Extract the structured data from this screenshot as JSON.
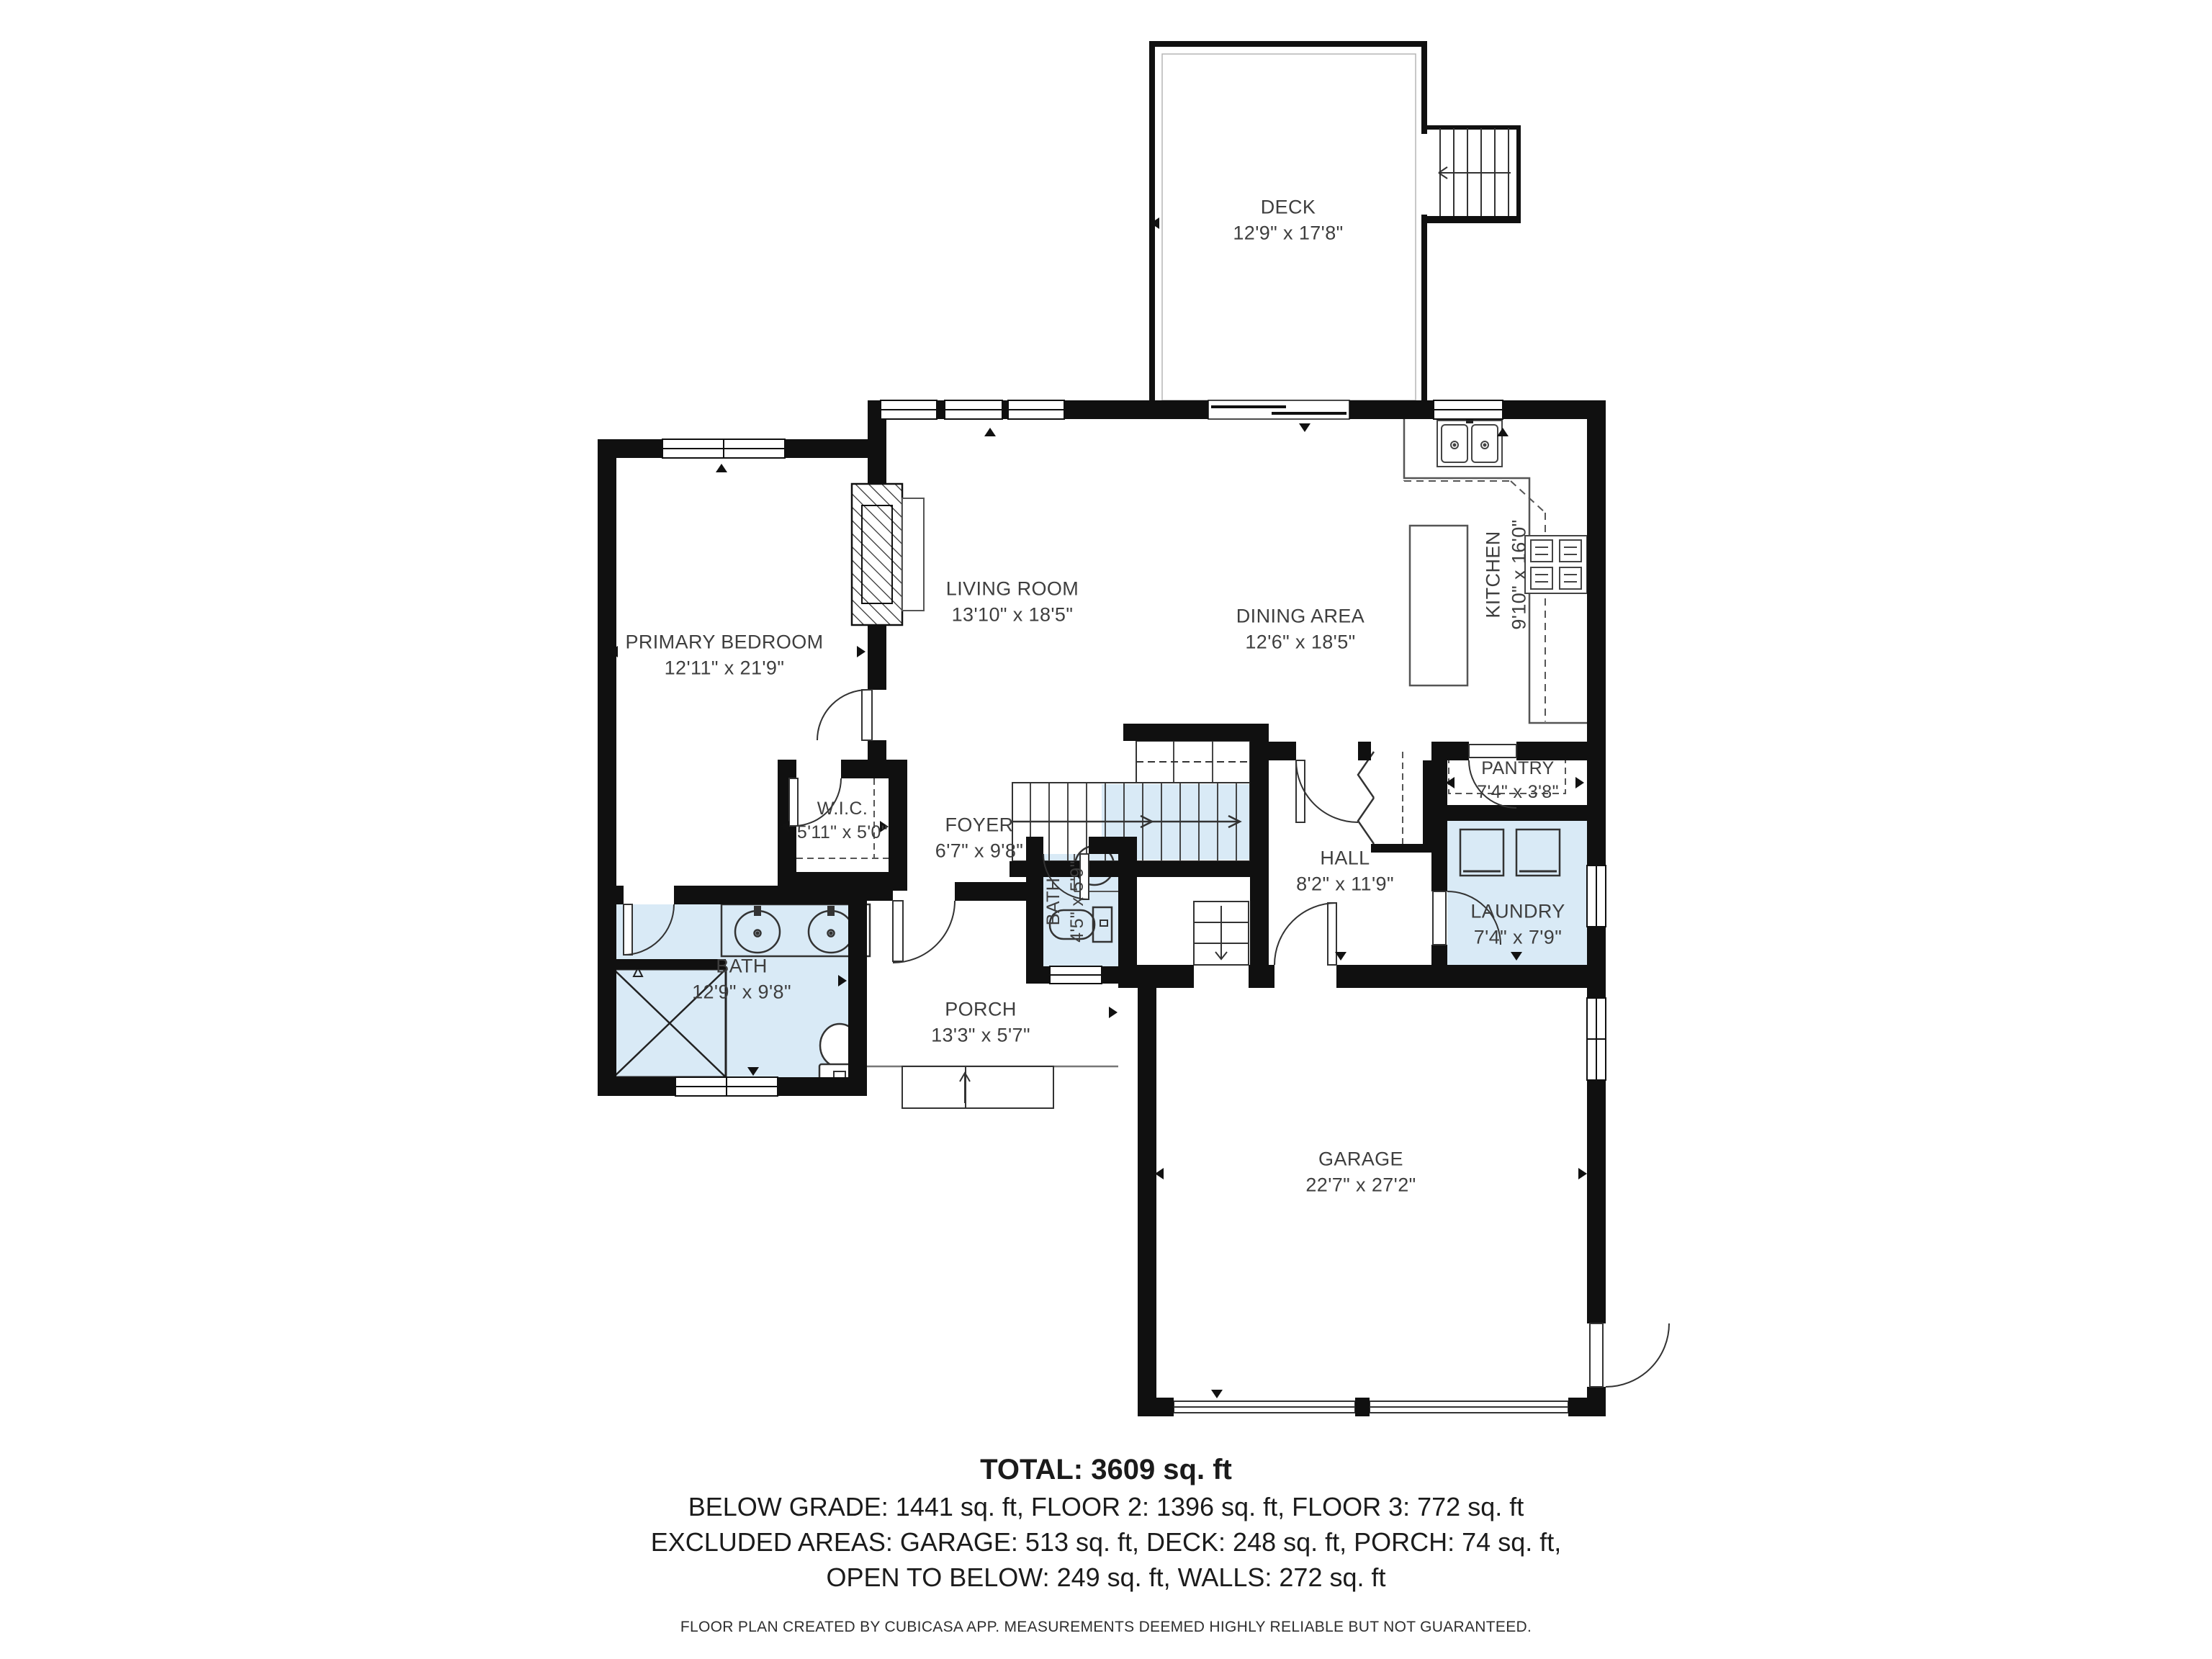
{
  "colors": {
    "wall": "#101010",
    "wet_fill": "#d9eaf6",
    "label_text": "#3e3e3e",
    "line": "#4a4a4a"
  },
  "rooms": [
    {
      "id": "deck",
      "name": "DECK",
      "dims": "12'9\" x 17'8\""
    },
    {
      "id": "living",
      "name": "LIVING ROOM",
      "dims": "13'10\" x 18'5\""
    },
    {
      "id": "dining",
      "name": "DINING AREA",
      "dims": "12'6\" x 18'5\""
    },
    {
      "id": "kitchen",
      "name": "KITCHEN",
      "dims": "9'10\" x 16'0\""
    },
    {
      "id": "primary",
      "name": "PRIMARY BEDROOM",
      "dims": "12'11\" x 21'9\""
    },
    {
      "id": "wic",
      "name": "W.I.C.",
      "dims": "5'11\" x 5'0\""
    },
    {
      "id": "foyer",
      "name": "FOYER",
      "dims": "6'7\" x 9'8\""
    },
    {
      "id": "pantry",
      "name": "PANTRY",
      "dims": "7'4\" x 3'8\""
    },
    {
      "id": "hall",
      "name": "HALL",
      "dims": "8'2\" x 11'9\""
    },
    {
      "id": "laundry",
      "name": "LAUNDRY",
      "dims": "7'4\" x 7'9\""
    },
    {
      "id": "bath",
      "name": "BATH",
      "dims": "12'9\" x 9'8\""
    },
    {
      "id": "bath2",
      "name": "BATH",
      "dims": "4'5\" x 5'9\""
    },
    {
      "id": "porch",
      "name": "PORCH",
      "dims": "13'3\" x 5'7\""
    },
    {
      "id": "garage",
      "name": "GARAGE",
      "dims": "22'7\" x 27'2\""
    }
  ],
  "summary": {
    "total": "TOTAL: 3609 sq. ft",
    "line2": "BELOW GRADE: 1441 sq. ft, FLOOR 2: 1396 sq. ft, FLOOR 3: 772 sq. ft",
    "line3": "EXCLUDED AREAS: GARAGE: 513 sq. ft, DECK: 248 sq. ft, PORCH: 74 sq. ft,",
    "line4": "OPEN TO BELOW: 249 sq. ft, WALLS: 272 sq. ft"
  },
  "footer": "FLOOR PLAN CREATED BY CUBICASA APP. MEASUREMENTS DEEMED HIGHLY RELIABLE BUT NOT GUARANTEED."
}
